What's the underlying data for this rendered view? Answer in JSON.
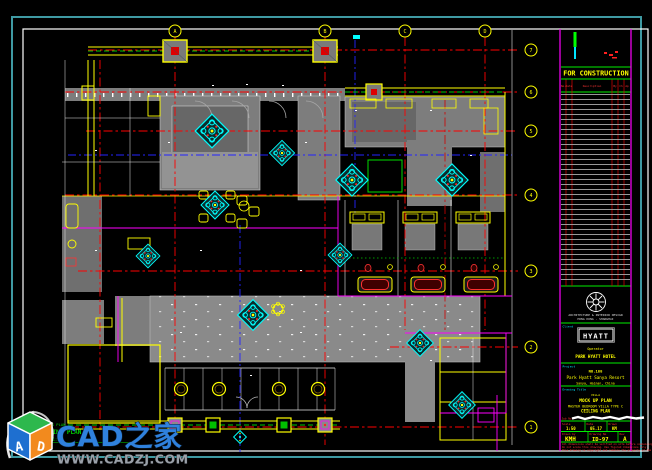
{
  "sheet": {
    "status_stamp": "FOR CONSTRUCTION",
    "revision_headers": [
      "No.",
      "Date",
      "Description",
      "By",
      "Ch",
      "Ap"
    ],
    "firm_line1": "ARCHITECTURE & INTERIOR DESIGN",
    "firm_line2": "HONG KONG · SHANGHAI",
    "client_label": "Client",
    "client_logo": "HYATT",
    "client_line1": "Operator",
    "client_line2": "PARK HYATT HOTEL",
    "project_label": "Project",
    "project_line1": "NO.188",
    "project_line2": "Park Hyatt Sanya Resort",
    "project_line3": "Sanya, Hainan, China",
    "title_label": "Drawing Title",
    "title_line1": "VILLA",
    "title_line2": "MOCK UP PLAN",
    "title_line3": "MASTER BEDROOM VILLA TYPE C",
    "title_line4": "CEILING PLAN",
    "job_label": "Job No",
    "scale_label": "Scale",
    "scale_value": "1:50",
    "date_label": "Date",
    "date_value": "05.17",
    "drawn_label": "Drawn",
    "drawn_value": "KM",
    "by_label": "Drawn by",
    "by_value": "KMH",
    "no_label": "Drawing No",
    "no_value": "ID-97",
    "rev_label": "Rev",
    "rev_value": "A",
    "note1": "All dimensions shall be verified on site before commencing work.",
    "note2": "Do not scale this drawing. Use figured dimensions only.",
    "note3": "This drawing is copyright and remains the property of the designer."
  },
  "plan": {
    "bubbles_top": [
      "A",
      "B",
      "C",
      "D"
    ],
    "bubbles_right": [
      "7",
      "6",
      "5",
      "4",
      "3",
      "2",
      "1"
    ],
    "view_line1": "DRAWING PLAN",
    "view_line2": "CEILING PLAN",
    "view_scale": "SCALE 1:50"
  },
  "watermark": {
    "brand": "CAD之家",
    "url": "WWW.CADZJ.COM",
    "cube_a": "A",
    "cube_d": "D"
  },
  "colors": {
    "border_teal": "#3f9aa3",
    "grid_red": "#ff0000",
    "centerline_blue": "#2323ff",
    "wall_yellow": "#ffff00",
    "wall_magenta": "#ff00ff",
    "detail_cyan": "#00ffff",
    "ok_green": "#00ee00",
    "brand_blue": "#2f81dd"
  }
}
